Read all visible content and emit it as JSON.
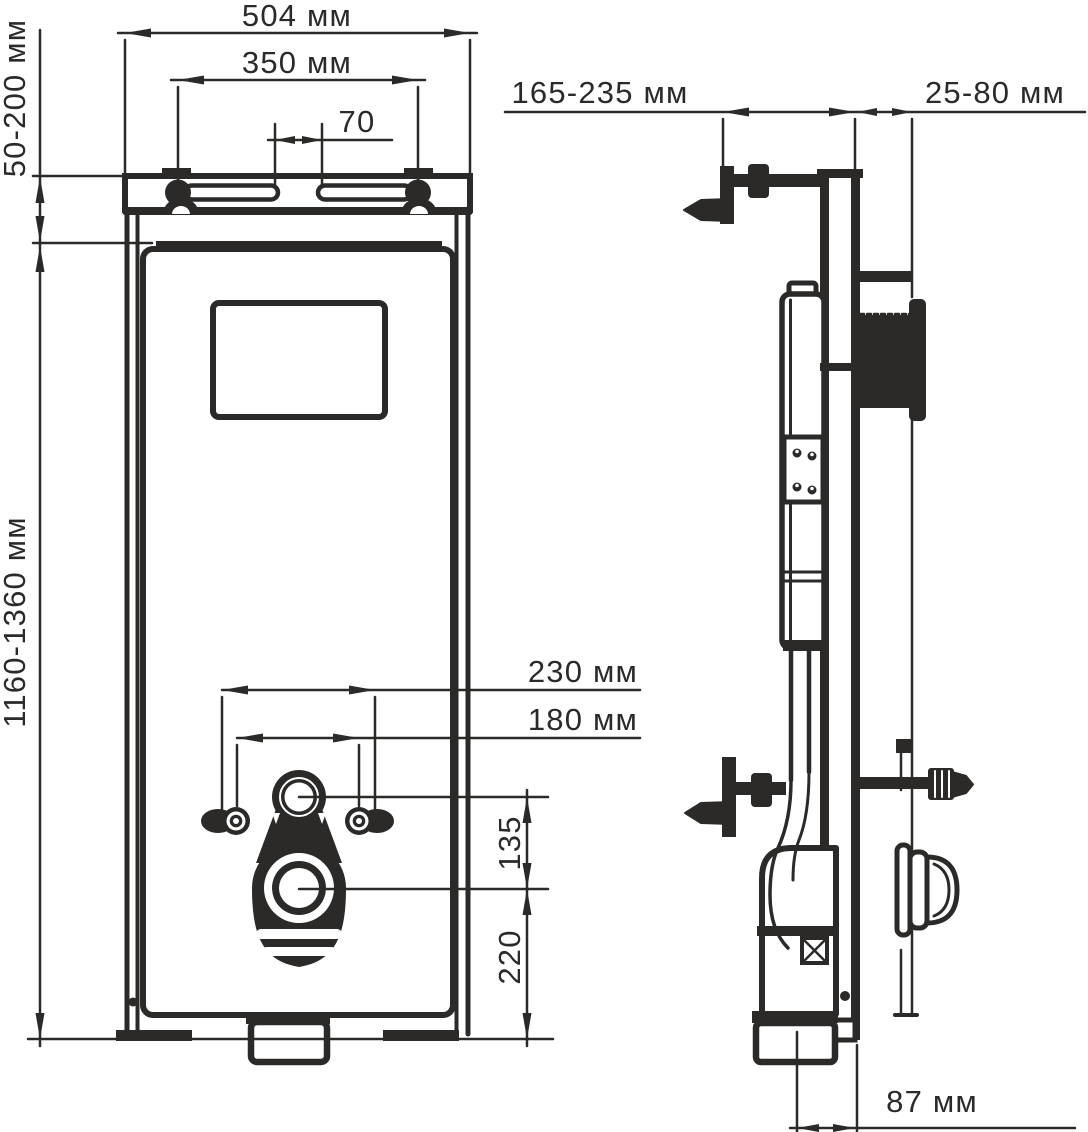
{
  "drawing": {
    "type": "installation-frame-technical-drawing",
    "language": "ru",
    "units": "мм",
    "colors": {
      "ink": "#2b2a29",
      "background": "#ffffff"
    },
    "front_view": {
      "dim_frame_width": "504 мм",
      "dim_hanger_bolt_spacing": "350 мм",
      "dim_slot_gap": "70",
      "dim_top_adjust_range": "50-200 мм",
      "dim_install_height_range": "1160-1360 мм",
      "dim_fixing_outer_spacing": "230 мм",
      "dim_fixing_inner_spacing": "180 мм",
      "dim_bracket_to_outlet": "135",
      "dim_outlet_to_floor": "220"
    },
    "side_view": {
      "dim_wall_bracket_depth": "165-235 мм",
      "dim_frame_to_wall": "25-80 мм",
      "dim_outlet_axis_to_frame": "87 мм"
    }
  }
}
